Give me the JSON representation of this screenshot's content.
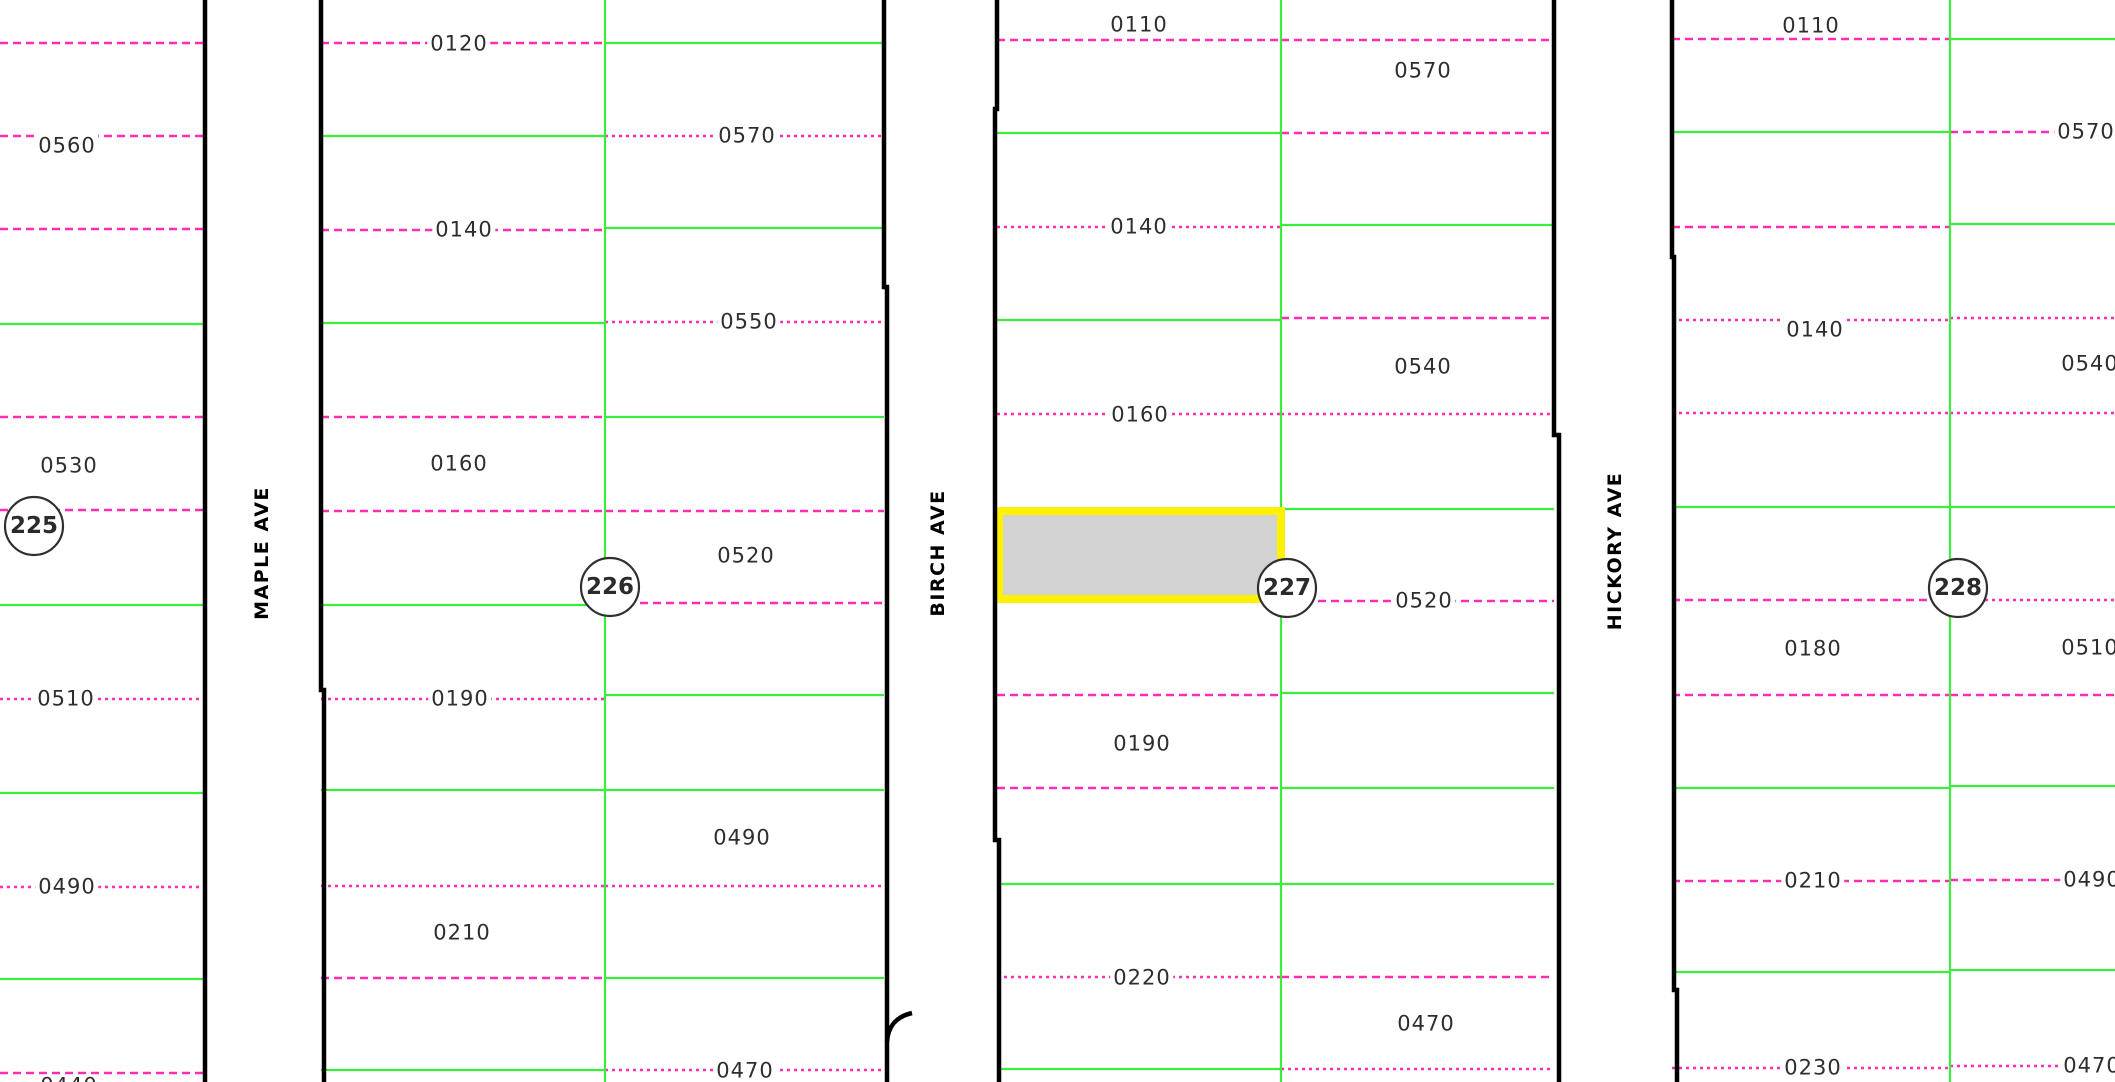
{
  "map": {
    "width": 2115,
    "height": 1082,
    "colors": {
      "background": "#FFFFFF",
      "lot_line_pink": "#FF2DB2",
      "boundary_green": "#3CEE3C",
      "street_black": "#000000",
      "highlight_fill": "#D2D2D2",
      "highlight_border": "#FFF200",
      "circle_stroke": "#303030",
      "label_text": "#2E2E2E"
    },
    "streets": [
      {
        "name": "MAPLE AVE",
        "label_x": 262,
        "label_y": 553,
        "edges": [
          "M 205 0 L 205 1082",
          "M 321 0 L 321 690 L 324 690 L 324 1082"
        ]
      },
      {
        "name": "BIRCH AVE",
        "label_x": 938,
        "label_y": 553,
        "edges": [
          "M 884 0 L 884 287 L 887 287 L 887 1082",
          "M 887 1042 C 888 1027 895 1017 912 1013",
          "M 997 0 L 997 109 L 995 109 L 995 840 L 999 840 L 999 1082"
        ]
      },
      {
        "name": "HICKORY AVE",
        "label_x": 1615,
        "label_y": 551,
        "edges": [
          "M 1554 0 L 1554 435 L 1559 435 L 1559 1082",
          "M 1672 0 L 1672 257 L 1674 257 L 1674 990 L 1677 990 L 1677 1082"
        ]
      }
    ],
    "block_dividers": [
      {
        "x": 605
      },
      {
        "x": 1281
      },
      {
        "x": 1950
      }
    ],
    "block_circles": [
      {
        "id": "225",
        "cx": 34,
        "cy": 526,
        "r": 29
      },
      {
        "id": "226",
        "cx": 610,
        "cy": 587,
        "r": 29
      },
      {
        "id": "227",
        "cx": 1287,
        "cy": 588,
        "r": 29
      },
      {
        "id": "228",
        "cx": 1958,
        "cy": 588,
        "r": 29
      }
    ],
    "highlight_parcel": {
      "x": 995,
      "y": 507,
      "width": 290,
      "height": 96,
      "border_width": 8
    },
    "lot_lines": [
      {
        "x1": 0,
        "x2": 205,
        "y": 43,
        "color": "pink",
        "dash": "dashed"
      },
      {
        "x1": 0,
        "x2": 205,
        "y": 136,
        "color": "pink",
        "dash": "dashed"
      },
      {
        "x1": 0,
        "x2": 205,
        "y": 229,
        "color": "pink",
        "dash": "dashed"
      },
      {
        "x1": 0,
        "x2": 205,
        "y": 324,
        "color": "green",
        "dash": "solid"
      },
      {
        "x1": 0,
        "x2": 205,
        "y": 417,
        "color": "pink",
        "dash": "dashed"
      },
      {
        "x1": 0,
        "x2": 205,
        "y": 510,
        "color": "pink",
        "dash": "dashed"
      },
      {
        "x1": 0,
        "x2": 205,
        "y": 605,
        "color": "green",
        "dash": "solid"
      },
      {
        "x1": 0,
        "x2": 205,
        "y": 699,
        "color": "pink",
        "dash": "dotted"
      },
      {
        "x1": 0,
        "x2": 205,
        "y": 793,
        "color": "green",
        "dash": "solid"
      },
      {
        "x1": 0,
        "x2": 205,
        "y": 887,
        "color": "pink",
        "dash": "dotted"
      },
      {
        "x1": 0,
        "x2": 205,
        "y": 979,
        "color": "green",
        "dash": "solid"
      },
      {
        "x1": 0,
        "x2": 205,
        "y": 1073,
        "color": "pink",
        "dash": "dashed"
      },
      {
        "x1": 321,
        "x2": 605,
        "y": 43,
        "color": "pink",
        "dash": "dashed"
      },
      {
        "x1": 321,
        "x2": 605,
        "y": 136,
        "color": "green",
        "dash": "solid"
      },
      {
        "x1": 321,
        "x2": 605,
        "y": 230,
        "color": "pink",
        "dash": "dashed"
      },
      {
        "x1": 321,
        "x2": 605,
        "y": 323,
        "color": "green",
        "dash": "solid"
      },
      {
        "x1": 321,
        "x2": 605,
        "y": 417,
        "color": "pink",
        "dash": "dashed"
      },
      {
        "x1": 321,
        "x2": 605,
        "y": 511,
        "color": "pink",
        "dash": "dashed"
      },
      {
        "x1": 321,
        "x2": 605,
        "y": 605,
        "color": "green",
        "dash": "solid"
      },
      {
        "x1": 321,
        "x2": 605,
        "y": 699,
        "color": "pink",
        "dash": "dotted"
      },
      {
        "x1": 321,
        "x2": 605,
        "y": 790,
        "color": "green",
        "dash": "solid"
      },
      {
        "x1": 321,
        "x2": 605,
        "y": 886,
        "color": "pink",
        "dash": "dotted"
      },
      {
        "x1": 321,
        "x2": 605,
        "y": 978,
        "color": "pink",
        "dash": "dashed"
      },
      {
        "x1": 321,
        "x2": 605,
        "y": 1070,
        "color": "green",
        "dash": "solid"
      },
      {
        "x1": 605,
        "x2": 884,
        "y": 43,
        "color": "green",
        "dash": "solid"
      },
      {
        "x1": 605,
        "x2": 884,
        "y": 136,
        "color": "pink",
        "dash": "dotted"
      },
      {
        "x1": 605,
        "x2": 884,
        "y": 228,
        "color": "green",
        "dash": "solid"
      },
      {
        "x1": 605,
        "x2": 884,
        "y": 322,
        "color": "pink",
        "dash": "dotted"
      },
      {
        "x1": 605,
        "x2": 884,
        "y": 417,
        "color": "green",
        "dash": "solid"
      },
      {
        "x1": 605,
        "x2": 884,
        "y": 511,
        "color": "pink",
        "dash": "dashed"
      },
      {
        "x1": 640,
        "x2": 884,
        "y": 603,
        "color": "pink",
        "dash": "dashed"
      },
      {
        "x1": 605,
        "x2": 884,
        "y": 695,
        "color": "green",
        "dash": "solid"
      },
      {
        "x1": 605,
        "x2": 884,
        "y": 790,
        "color": "green",
        "dash": "solid"
      },
      {
        "x1": 605,
        "x2": 884,
        "y": 886,
        "color": "pink",
        "dash": "dotted"
      },
      {
        "x1": 605,
        "x2": 884,
        "y": 978,
        "color": "green",
        "dash": "solid"
      },
      {
        "x1": 605,
        "x2": 884,
        "y": 1070,
        "color": "pink",
        "dash": "dotted"
      },
      {
        "x1": 997,
        "x2": 1281,
        "y": 40,
        "color": "pink",
        "dash": "dashed"
      },
      {
        "x1": 997,
        "x2": 1281,
        "y": 133,
        "color": "green",
        "dash": "solid"
      },
      {
        "x1": 997,
        "x2": 1281,
        "y": 227,
        "color": "pink",
        "dash": "dotted"
      },
      {
        "x1": 997,
        "x2": 1281,
        "y": 320,
        "color": "green",
        "dash": "solid"
      },
      {
        "x1": 997,
        "x2": 1281,
        "y": 414,
        "color": "pink",
        "dash": "dotted"
      },
      {
        "x1": 997,
        "x2": 1281,
        "y": 695,
        "color": "pink",
        "dash": "dashed"
      },
      {
        "x1": 997,
        "x2": 1281,
        "y": 788,
        "color": "pink",
        "dash": "dashed"
      },
      {
        "x1": 997,
        "x2": 1281,
        "y": 884,
        "color": "green",
        "dash": "solid"
      },
      {
        "x1": 997,
        "x2": 1281,
        "y": 977,
        "color": "pink",
        "dash": "dotted"
      },
      {
        "x1": 997,
        "x2": 1281,
        "y": 1069,
        "color": "green",
        "dash": "solid"
      },
      {
        "x1": 1281,
        "x2": 1554,
        "y": 40,
        "color": "pink",
        "dash": "dashed"
      },
      {
        "x1": 1281,
        "x2": 1554,
        "y": 133,
        "color": "pink",
        "dash": "dashed"
      },
      {
        "x1": 1281,
        "x2": 1554,
        "y": 225,
        "color": "green",
        "dash": "solid"
      },
      {
        "x1": 1281,
        "x2": 1554,
        "y": 318,
        "color": "pink",
        "dash": "dashed"
      },
      {
        "x1": 1281,
        "x2": 1554,
        "y": 414,
        "color": "pink",
        "dash": "dotted"
      },
      {
        "x1": 1281,
        "x2": 1554,
        "y": 509,
        "color": "green",
        "dash": "solid"
      },
      {
        "x1": 1318,
        "x2": 1554,
        "y": 601,
        "color": "pink",
        "dash": "dashed"
      },
      {
        "x1": 1281,
        "x2": 1554,
        "y": 693,
        "color": "green",
        "dash": "solid"
      },
      {
        "x1": 1281,
        "x2": 1554,
        "y": 788,
        "color": "green",
        "dash": "solid"
      },
      {
        "x1": 1281,
        "x2": 1554,
        "y": 884,
        "color": "green",
        "dash": "solid"
      },
      {
        "x1": 1281,
        "x2": 1554,
        "y": 977,
        "color": "pink",
        "dash": "dashed"
      },
      {
        "x1": 1281,
        "x2": 1554,
        "y": 1069,
        "color": "pink",
        "dash": "dotted"
      },
      {
        "x1": 1672,
        "x2": 1950,
        "y": 39,
        "color": "pink",
        "dash": "dashed"
      },
      {
        "x1": 1672,
        "x2": 1950,
        "y": 132,
        "color": "green",
        "dash": "solid"
      },
      {
        "x1": 1672,
        "x2": 1950,
        "y": 227,
        "color": "pink",
        "dash": "dashed"
      },
      {
        "x1": 1672,
        "x2": 1950,
        "y": 320,
        "color": "pink",
        "dash": "dotted"
      },
      {
        "x1": 1672,
        "x2": 1950,
        "y": 413,
        "color": "pink",
        "dash": "dotted"
      },
      {
        "x1": 1672,
        "x2": 1950,
        "y": 507,
        "color": "green",
        "dash": "solid"
      },
      {
        "x1": 1672,
        "x2": 1950,
        "y": 600,
        "color": "pink",
        "dash": "dashed"
      },
      {
        "x1": 1672,
        "x2": 1950,
        "y": 695,
        "color": "pink",
        "dash": "dashed"
      },
      {
        "x1": 1672,
        "x2": 1950,
        "y": 788,
        "color": "green",
        "dash": "solid"
      },
      {
        "x1": 1672,
        "x2": 1950,
        "y": 881,
        "color": "pink",
        "dash": "dashed"
      },
      {
        "x1": 1672,
        "x2": 1950,
        "y": 972,
        "color": "green",
        "dash": "solid"
      },
      {
        "x1": 1672,
        "x2": 1950,
        "y": 1068,
        "color": "pink",
        "dash": "dotted"
      },
      {
        "x1": 1950,
        "x2": 2115,
        "y": 39,
        "color": "green",
        "dash": "solid"
      },
      {
        "x1": 1950,
        "x2": 2115,
        "y": 132,
        "color": "pink",
        "dash": "dashed"
      },
      {
        "x1": 1950,
        "x2": 2115,
        "y": 224,
        "color": "green",
        "dash": "solid"
      },
      {
        "x1": 1950,
        "x2": 2115,
        "y": 318,
        "color": "pink",
        "dash": "dotted"
      },
      {
        "x1": 1950,
        "x2": 2115,
        "y": 413,
        "color": "pink",
        "dash": "dotted"
      },
      {
        "x1": 1950,
        "x2": 2115,
        "y": 507,
        "color": "green",
        "dash": "solid"
      },
      {
        "x1": 1950,
        "x2": 2115,
        "y": 600,
        "color": "pink",
        "dash": "dotted"
      },
      {
        "x1": 1950,
        "x2": 2115,
        "y": 695,
        "color": "pink",
        "dash": "dashed"
      },
      {
        "x1": 1950,
        "x2": 2115,
        "y": 786,
        "color": "green",
        "dash": "solid"
      },
      {
        "x1": 1950,
        "x2": 2115,
        "y": 880,
        "color": "pink",
        "dash": "dashed"
      },
      {
        "x1": 1950,
        "x2": 2115,
        "y": 970,
        "color": "green",
        "dash": "solid"
      },
      {
        "x1": 1950,
        "x2": 2115,
        "y": 1066,
        "color": "pink",
        "dash": "dotted"
      }
    ],
    "lot_labels": [
      {
        "text": "0560",
        "x": 67,
        "y": 146
      },
      {
        "text": "0530",
        "x": 69,
        "y": 466
      },
      {
        "text": "0510",
        "x": 66,
        "y": 699
      },
      {
        "text": "0490",
        "x": 67,
        "y": 887
      },
      {
        "text": "0440",
        "x": 69,
        "y": 1086
      },
      {
        "text": "0120",
        "x": 459,
        "y": 44
      },
      {
        "text": "0570",
        "x": 747,
        "y": 136
      },
      {
        "text": "0140",
        "x": 464,
        "y": 230
      },
      {
        "text": "0550",
        "x": 749,
        "y": 322
      },
      {
        "text": "0160",
        "x": 459,
        "y": 464
      },
      {
        "text": "0520",
        "x": 746,
        "y": 556
      },
      {
        "text": "0190",
        "x": 460,
        "y": 699
      },
      {
        "text": "0490",
        "x": 742,
        "y": 838
      },
      {
        "text": "0210",
        "x": 462,
        "y": 933
      },
      {
        "text": "0470",
        "x": 745,
        "y": 1071
      },
      {
        "text": "0110",
        "x": 1139,
        "y": 25
      },
      {
        "text": "0570",
        "x": 1423,
        "y": 71
      },
      {
        "text": "0140",
        "x": 1139,
        "y": 227
      },
      {
        "text": "0540",
        "x": 1423,
        "y": 367
      },
      {
        "text": "0160",
        "x": 1140,
        "y": 415
      },
      {
        "text": "0520",
        "x": 1424,
        "y": 601
      },
      {
        "text": "0190",
        "x": 1142,
        "y": 744
      },
      {
        "text": "0220",
        "x": 1142,
        "y": 978
      },
      {
        "text": "0470",
        "x": 1426,
        "y": 1024
      },
      {
        "text": "0110",
        "x": 1811,
        "y": 26
      },
      {
        "text": "0570",
        "x": 2086,
        "y": 132
      },
      {
        "text": "0140",
        "x": 1815,
        "y": 330
      },
      {
        "text": "0540",
        "x": 2090,
        "y": 364
      },
      {
        "text": "0180",
        "x": 1813,
        "y": 649
      },
      {
        "text": "0510",
        "x": 2090,
        "y": 648
      },
      {
        "text": "0210",
        "x": 1813,
        "y": 881
      },
      {
        "text": "0490",
        "x": 2092,
        "y": 880
      },
      {
        "text": "0230",
        "x": 1813,
        "y": 1068
      },
      {
        "text": "0470",
        "x": 2092,
        "y": 1066
      }
    ]
  }
}
